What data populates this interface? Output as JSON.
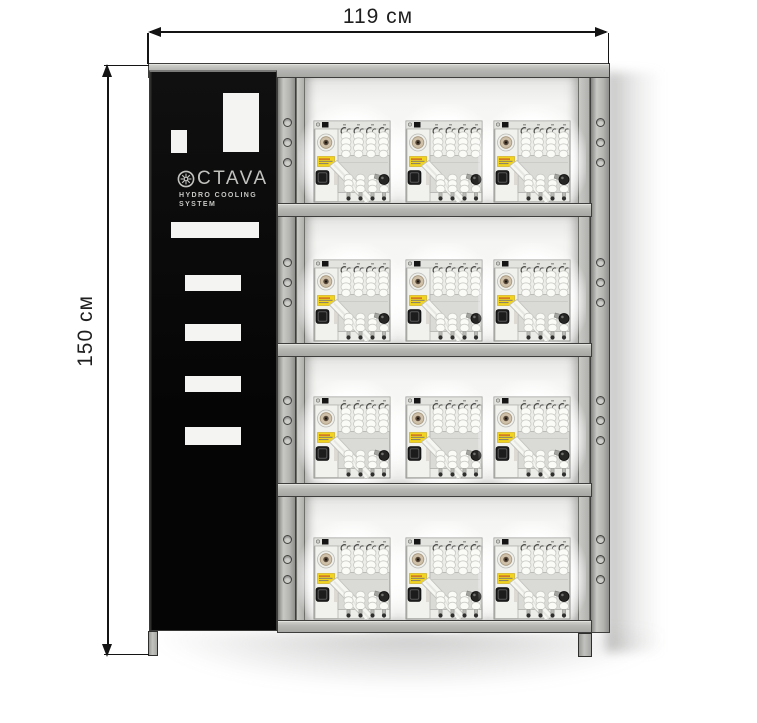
{
  "diagram": {
    "title": "OCTAVA hydro cooling system rack — dimensioned drawing",
    "width_dimension_label": "119 см",
    "height_dimension_label": "150 см"
  },
  "panel": {
    "brand_full": "OCTAVA",
    "brand_text": "CTAVA",
    "logo_icon": "snowflake-emblem-icon",
    "subtitle_line1": "HYDRO COOLING",
    "subtitle_line2": "SYSTEM"
  },
  "rack": {
    "shelf_rows": 4,
    "units_per_row": 3,
    "total_units": 12,
    "holes_per_post_section": 3,
    "unit_description": "hydro cooling unit with coiled hoses, round connector, yellow label and plug socket"
  },
  "colors": {
    "panel_black": "#0a0a0a",
    "frame_gray": "#b4b4b1",
    "unit_label_yellow": "#f2d41e",
    "unit_connector_tan": "#cec0a9",
    "dimension_line": "#141414"
  }
}
